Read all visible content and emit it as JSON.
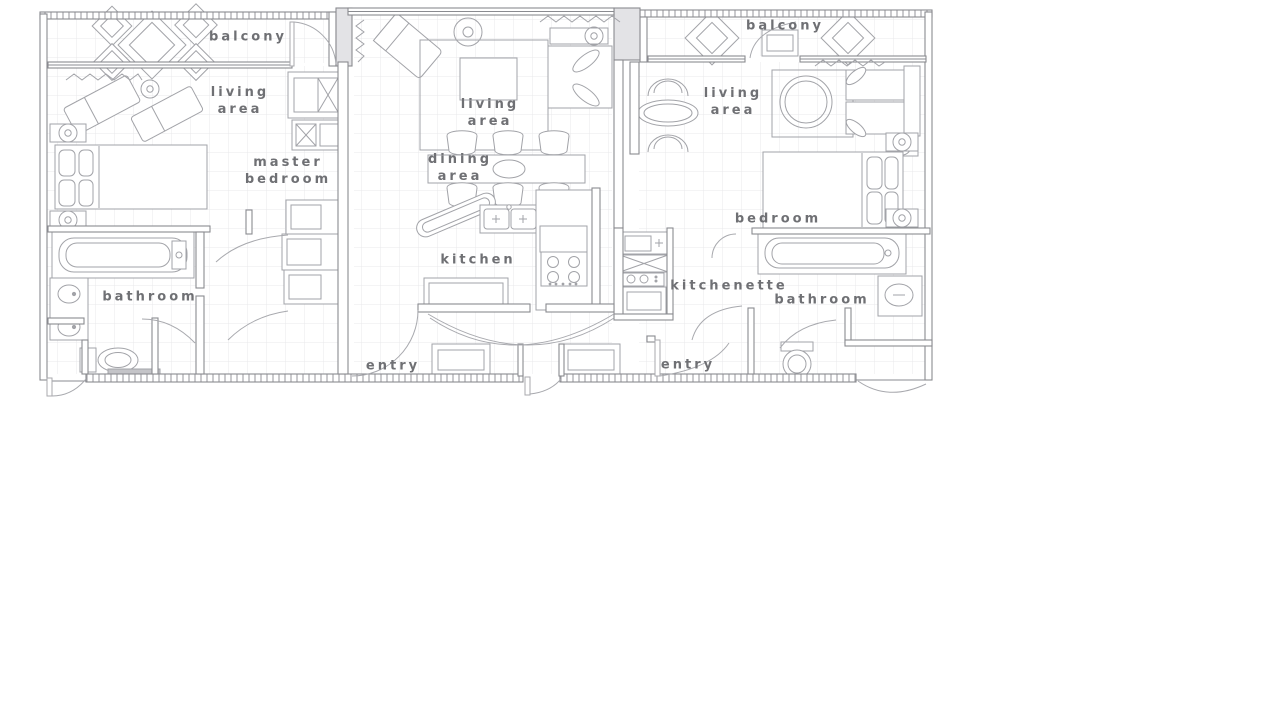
{
  "diagram": {
    "type": "floor-plan",
    "title": "Three-unit suite floor plan",
    "units": {
      "left_unit_rooms": [
        "balcony",
        "living area",
        "master bedroom",
        "bathroom"
      ],
      "center_unit_rooms": [
        "living area",
        "dining area",
        "kitchen",
        "entry"
      ],
      "right_unit_rooms": [
        "balcony",
        "living area",
        "bedroom",
        "kitchenette",
        "bathroom",
        "entry"
      ]
    }
  },
  "colors": {
    "background": "#ffffff",
    "wall_line": "#8a8b90",
    "furniture_line": "#a2a3a8",
    "grid_line": "#e8e8eb",
    "label_text": "#6f7074"
  },
  "labels": [
    {
      "id": "balcony-left",
      "text": "balcony"
    },
    {
      "id": "living-area-left",
      "text": "living area"
    },
    {
      "id": "master-bedroom",
      "text": "master bedroom"
    },
    {
      "id": "bathroom-left",
      "text": "bathroom"
    },
    {
      "id": "entry-left",
      "text": "entry"
    },
    {
      "id": "living-area-center",
      "text": "living area"
    },
    {
      "id": "dining-area",
      "text": "dining area"
    },
    {
      "id": "kitchen",
      "text": "kitchen"
    },
    {
      "id": "balcony-right",
      "text": "balcony"
    },
    {
      "id": "living-area-right",
      "text": "living area"
    },
    {
      "id": "bedroom-right",
      "text": "bedroom"
    },
    {
      "id": "kitchenette",
      "text": "kitchenette"
    },
    {
      "id": "bathroom-right",
      "text": "bathroom"
    },
    {
      "id": "entry-right",
      "text": "entry"
    }
  ]
}
